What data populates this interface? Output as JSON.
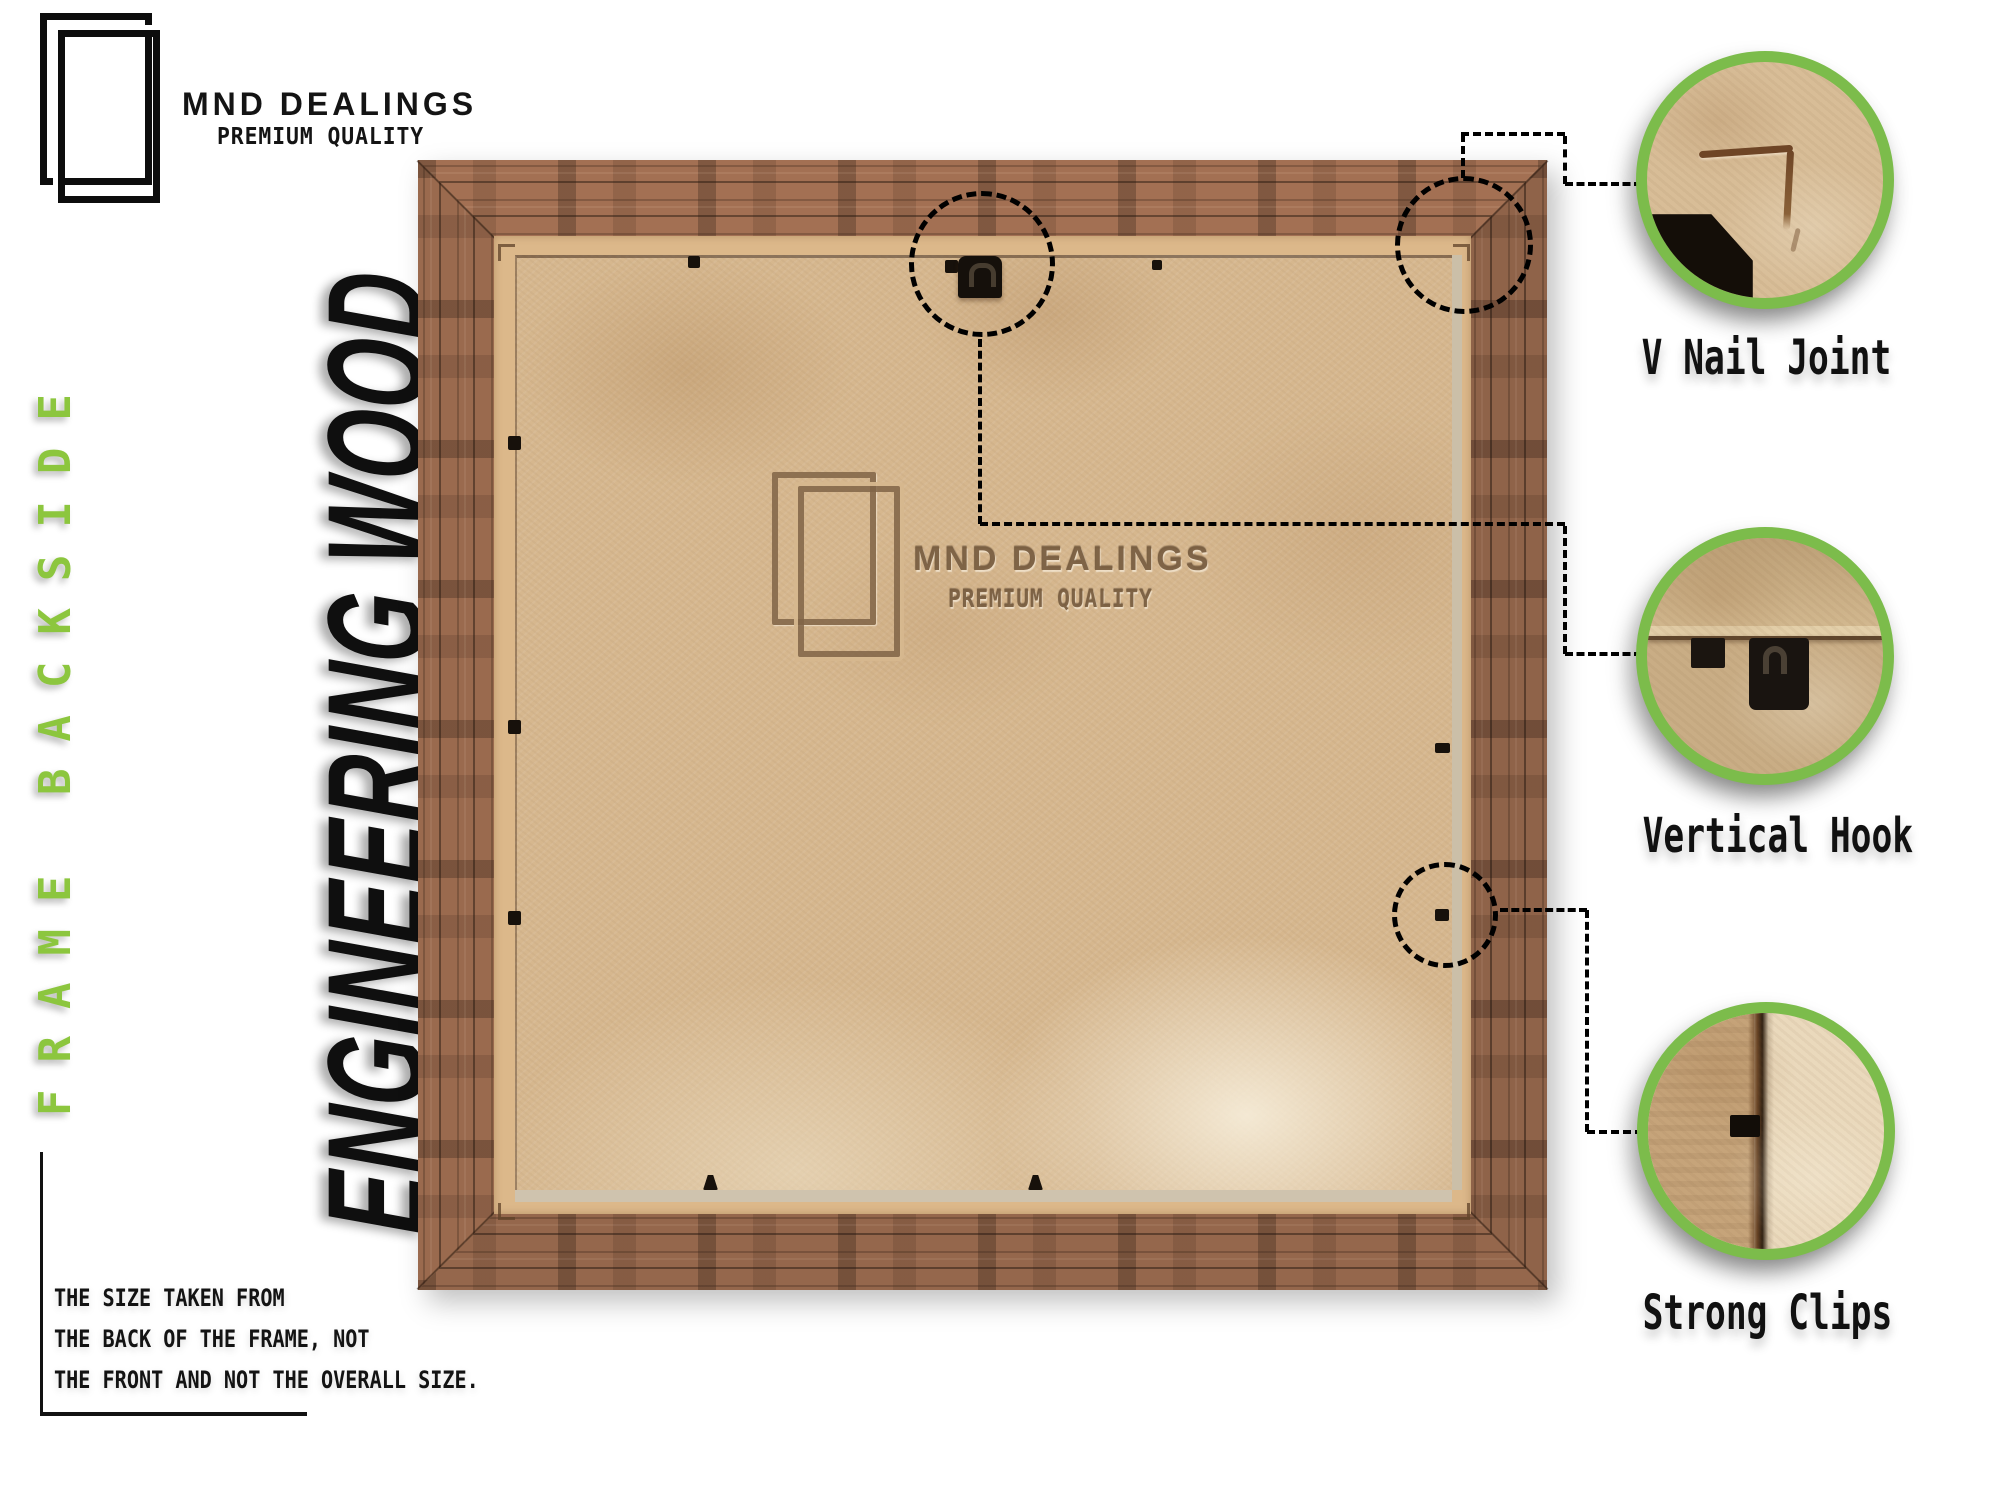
{
  "header": {
    "brand": "MND DEALINGS",
    "tagline": "PREMIUM QUALITY"
  },
  "left_rail": {
    "side_label": "FRAME BACKSIDE",
    "material_label": "ENGINEERING WOOD"
  },
  "watermark": {
    "brand": "MND DEALINGS",
    "tagline": "PREMIUM QUALITY"
  },
  "callouts": [
    {
      "id": "v-nail-joint",
      "label": "V Nail Joint"
    },
    {
      "id": "vertical-hook",
      "label": "Vertical Hook"
    },
    {
      "id": "strong-clips",
      "label": "Strong Clips"
    }
  ],
  "note": {
    "lines": [
      "THE SIZE TAKEN FROM",
      "THE BACK OF THE FRAME, NOT",
      "THE FRONT AND NOT THE OVERALL SIZE."
    ]
  },
  "colors": {
    "accent_green": "#7CBC4B",
    "side_label_green": "#8CC63E",
    "wood_brown": "#9A6A4E",
    "backing_tan": "#D6B78E",
    "ink": "#111111"
  }
}
